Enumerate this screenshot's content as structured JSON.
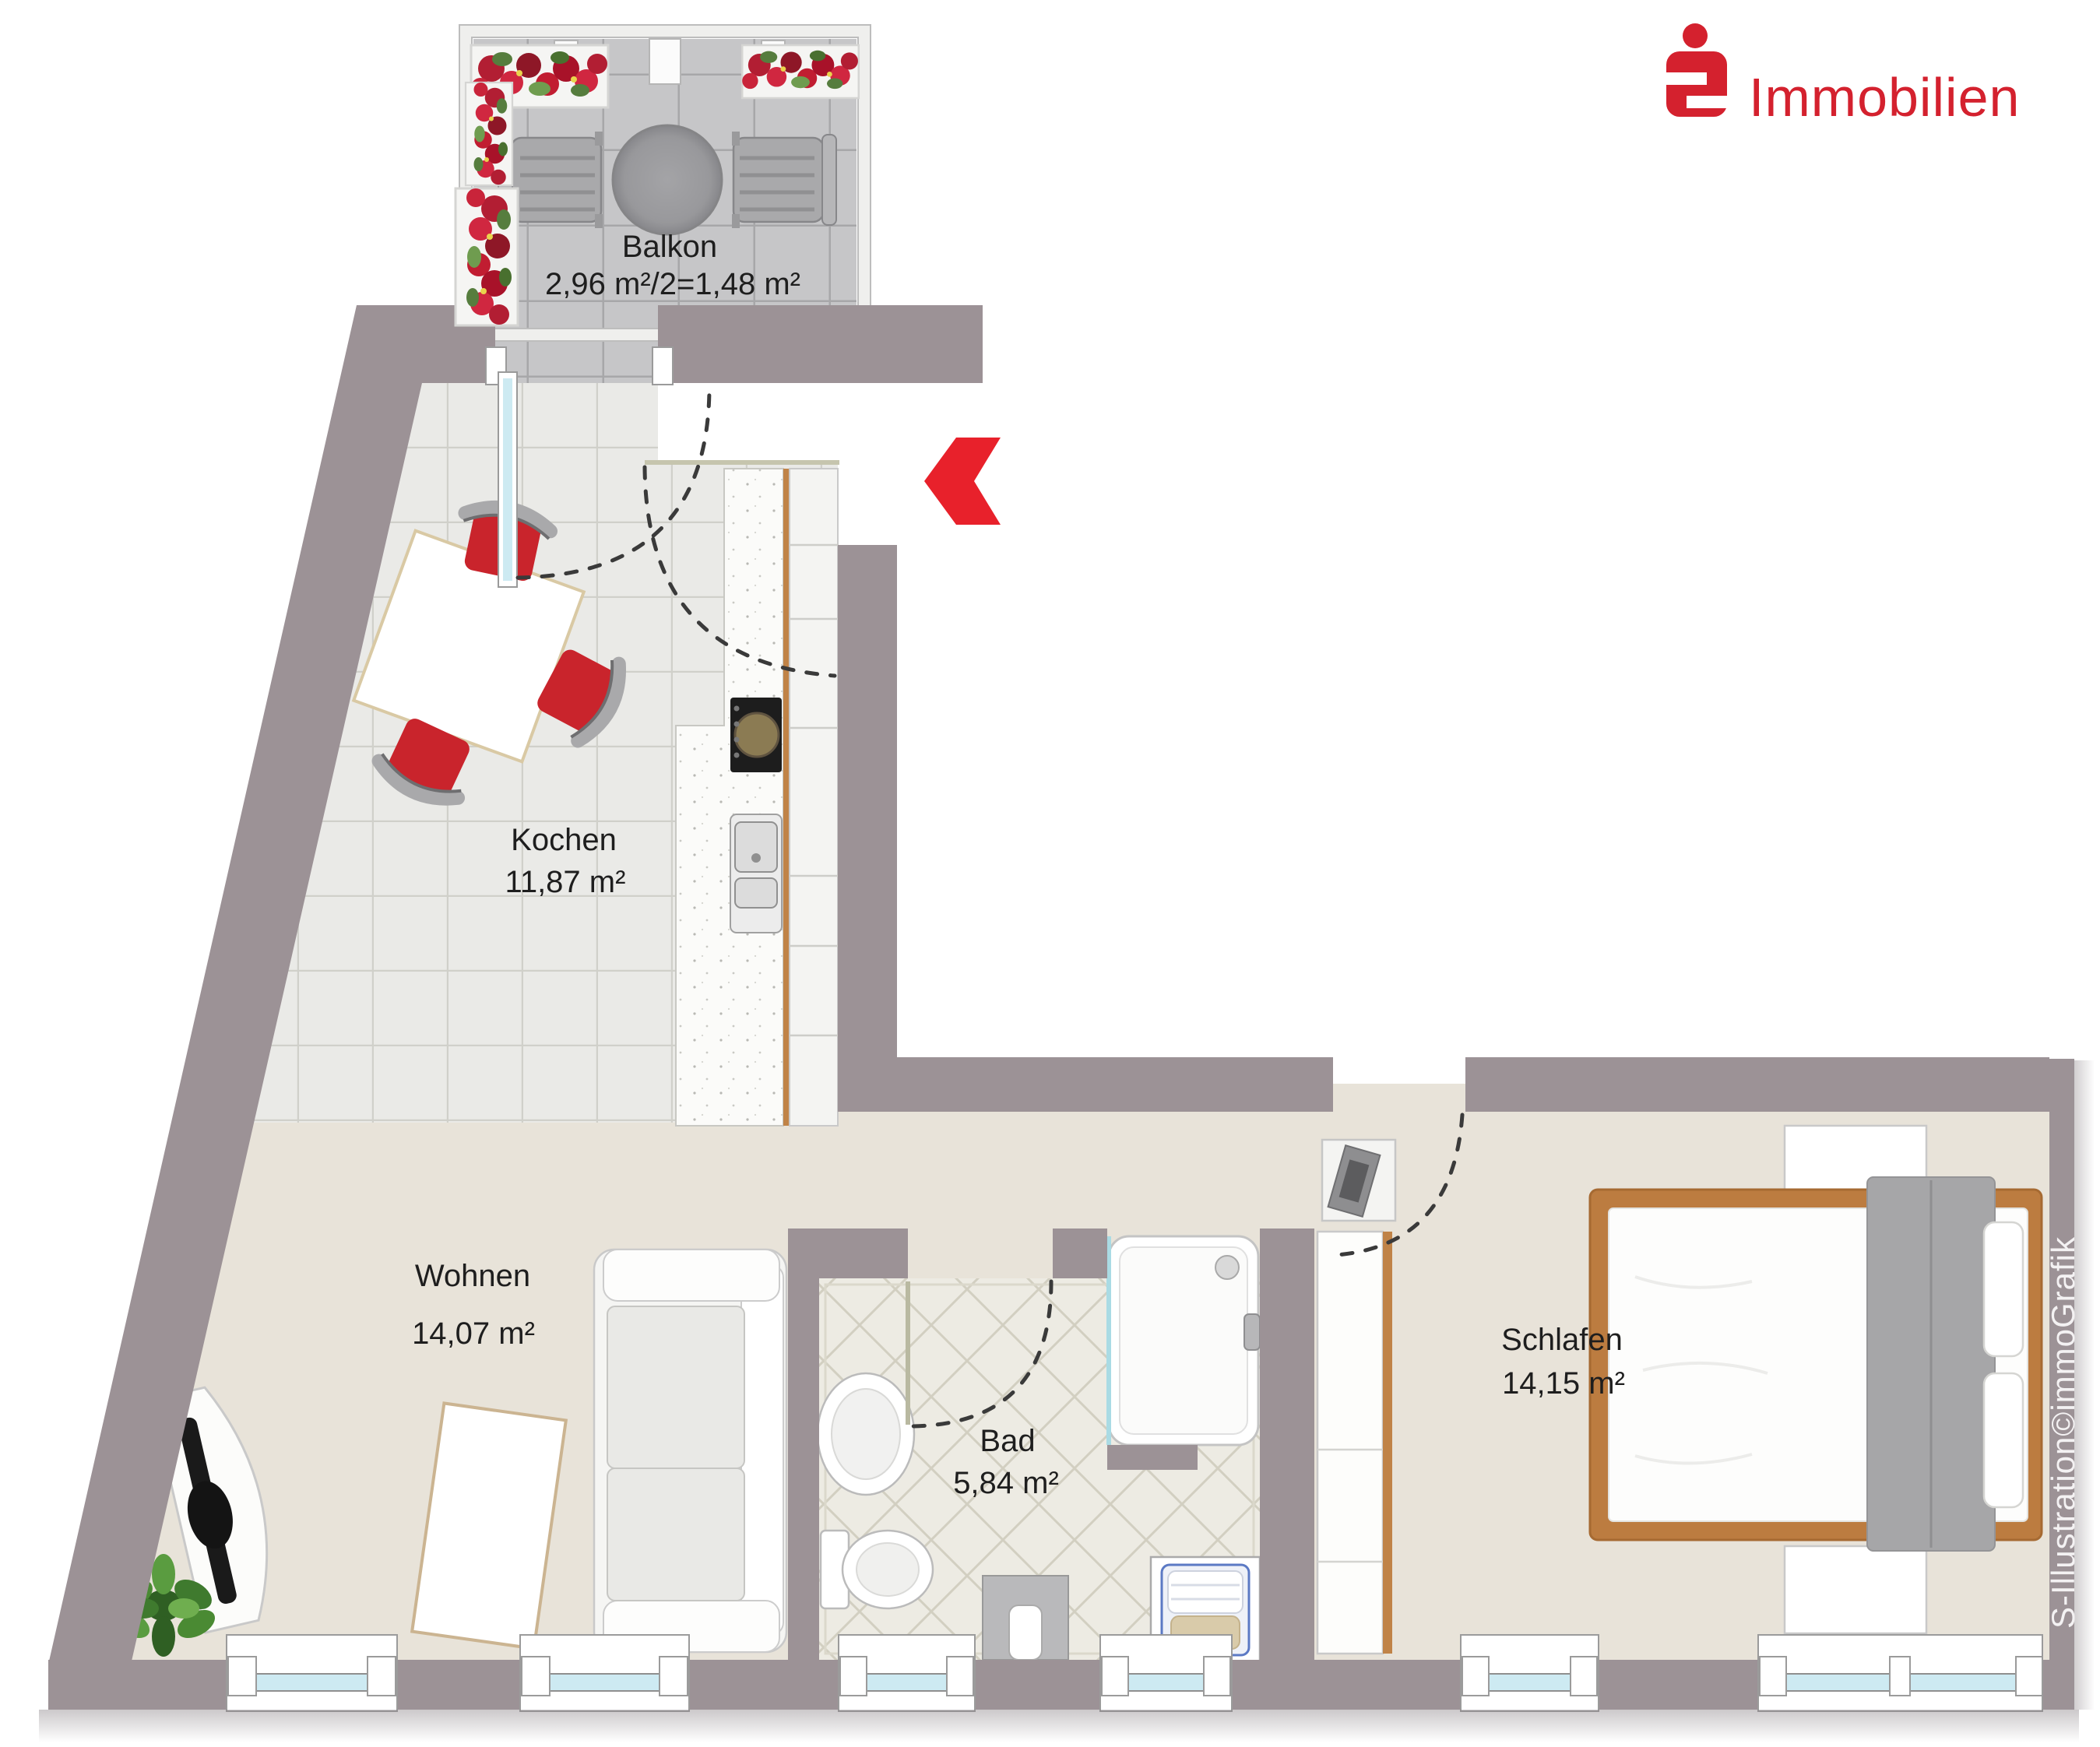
{
  "page": {
    "type": "floor-plan",
    "background": "#ffffff"
  },
  "brand": {
    "logo_symbol": "sparkasse-s",
    "logo_text": "Immobilien",
    "logo_color": "#d4212e",
    "credit_vertical": "S-Illustration©immoGrafik"
  },
  "entrance": {
    "marker": "red-arrow-left",
    "color": "#e8212b"
  },
  "rooms": [
    {
      "id": "balkon",
      "label": "Balkon",
      "area": "2,96 m²/2=1,48 m²"
    },
    {
      "id": "kochen",
      "label": "Kochen",
      "area": "11,87 m²"
    },
    {
      "id": "wohnen",
      "label": "Wohnen",
      "area": "14,07 m²"
    },
    {
      "id": "bad",
      "label": "Bad",
      "area": "5,84 m²"
    },
    {
      "id": "schlafen",
      "label": "Schlafen",
      "area": "14,15 m²"
    }
  ],
  "colors": {
    "wall": "#9c9296",
    "floor_beige": "#e8e3d9",
    "tile_kitchen": "#eaeae7",
    "tile_balcony": "#c6c6c8",
    "tile_bath": "#edebe3",
    "glass": "#cdeaf2",
    "wood": "#c08347",
    "chair_red": "#c9242c"
  }
}
